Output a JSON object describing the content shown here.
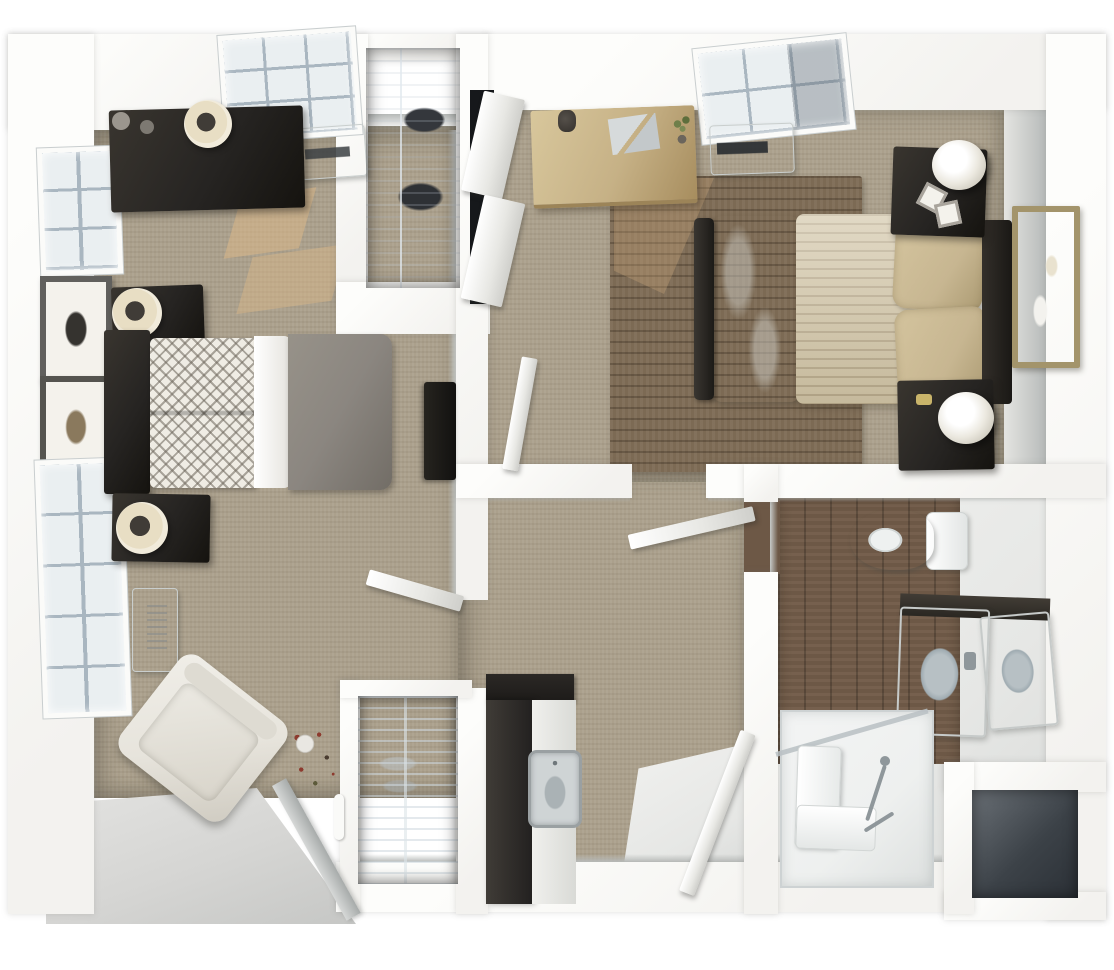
{
  "scene": {
    "type": "3d-floor-plan-dollhouse-render",
    "view": "top-down aerial 3D rendering",
    "description": "Aerial 3D dollhouse rendering of a furnished apartment floor plan: two bedrooms, a central hallway with kitchenette counter and closets, and an accessible bathroom with walk-in shower"
  },
  "palette": {
    "page": "#ffffff",
    "wall": "#f3f2ef",
    "wall-bright": "#fdfdfb",
    "face": "#c0c3c1",
    "carpet": "#aba08c",
    "rug": "#7c6a54",
    "wood": "#6d5846",
    "tile": "#e6e7e5",
    "patio": "#d5d5d3",
    "furn-dark": "#262422",
    "closet-dark": "#121417",
    "duvet-gray": "#8b8680",
    "duvet-cream": "#d2c5a6",
    "pillow-tan": "#c7b691",
    "sheet-white": "#f3f2ee",
    "chair-cream": "#e7e4dc",
    "desk-wood": "#c6b186",
    "gold": "#a3946b",
    "pane": "#eaeff1",
    "mullion": "#a9b6c0",
    "lamp-ring": "#e8dec4",
    "sun": "#e0b987",
    "accent-red": "#8d3b2f",
    "fixture-white": "#eef0ef",
    "fixture-gray": "#b7c0c4",
    "steel": "#8f979b"
  },
  "rooms": [
    {
      "id": "left-bedroom",
      "label": "Left bedroom with gray bed",
      "furniture": [
        "dark dresser with lamp",
        "bed with gray duvet and patterned pillows",
        "two nightstands with round lamps",
        "wall-mounted TV",
        "cream armchair",
        "wall heater",
        "wall AC unit",
        "two picture windows",
        "two framed artworks",
        "floor plant",
        "closet with hanging clothes",
        "closet with wire shelving",
        "sunlit carpet patches"
      ]
    },
    {
      "id": "right-bedroom",
      "label": "Right bedroom with cream bed",
      "furniture": [
        "wood desk with plant and papers",
        "brown area rug",
        "bed with cream duvet and tan pillows",
        "two dark nightstands with drum lamps",
        "gold framed wall mirror",
        "window with shade",
        "wall AC unit",
        "open closet door panels",
        "open entry door"
      ]
    },
    {
      "id": "hallway",
      "label": "Central hallway and entry",
      "furniture": [
        "dark kitchenette counter with sink",
        "open door leaves",
        "tiled entry floor"
      ]
    },
    {
      "id": "bathroom",
      "label": "Bathroom with walk-in shower",
      "furniture": [
        "toilet",
        "double sink vanity",
        "walk-in shower with bench and grab bars",
        "wood plank floor",
        "storage niche"
      ]
    }
  ]
}
